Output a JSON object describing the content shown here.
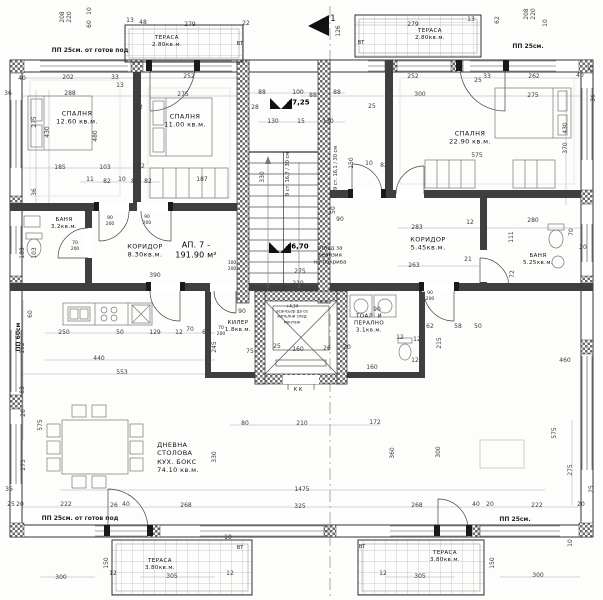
{
  "plan": {
    "apartment": {
      "t": "АП. 7 -\n191.90 м²",
      "x": 196,
      "y": 251
    },
    "rooms": [
      {
        "t": "СПАЛНЯ\n12.60 кв.м.",
        "x": 77,
        "y": 118
      },
      {
        "t": "СПАЛНЯ\n11.00 кв.м.",
        "x": 185,
        "y": 121
      },
      {
        "t": "СПАЛНЯ\n22.90 кв.м.",
        "x": 470,
        "y": 138
      },
      {
        "t": "ТЕРАСА\n2.80кв.м.",
        "x": 167,
        "y": 42,
        "s": 5.5
      },
      {
        "t": "ТЕРАСА\n2.80кв.м.",
        "x": 430,
        "y": 35,
        "s": 5.5
      },
      {
        "t": "БАНЯ\n3.2кв.м.",
        "x": 64,
        "y": 224,
        "s": 5.5
      },
      {
        "t": "КОРИДОР\n8.30кв.м.",
        "x": 145,
        "y": 251
      },
      {
        "t": "КОРИДОР\n5.45кв.м.",
        "x": 428,
        "y": 244
      },
      {
        "t": "БАНЯ\n5.25кв.м.",
        "x": 538,
        "y": 260,
        "s": 5.5
      },
      {
        "t": "КИЛЕР\n1.8кв.м.",
        "x": 238,
        "y": 327,
        "s": 5.5
      },
      {
        "t": "ТОАЛ. И\nПЕРАЛНО\n3.1кв.м.",
        "x": 369,
        "y": 324,
        "s": 5.5
      },
      {
        "t": "ДНЕВНА\nСТОЛОВА\nКУХ. БОКС\n74.10 кв.м.",
        "x": 178,
        "y": 458,
        "align": "left"
      },
      {
        "t": "ТЕРАСА\n3.80кв.м.",
        "x": 160,
        "y": 565,
        "s": 5.5
      },
      {
        "t": "ТЕРАСА\n3.80кв.м.",
        "x": 445,
        "y": 557,
        "s": 5.5
      }
    ],
    "levels": [
      {
        "t": "+7,25",
        "x": 298,
        "y": 103
      },
      {
        "t": "+6,70",
        "x": 297,
        "y": 247
      }
    ],
    "notes": [
      {
        "t": "ПП 25см. от готов под",
        "x": 90,
        "y": 51,
        "b": 1
      },
      {
        "t": "ПП 25см.",
        "x": 528,
        "y": 47,
        "b": 1
      },
      {
        "t": "ПП 25см. от готов под",
        "x": 80,
        "y": 519,
        "b": 1
      },
      {
        "t": "ПП 25см.",
        "x": 515,
        "y": 520,
        "b": 1
      },
      {
        "t": "ПП 60см",
        "x": 19,
        "y": 337,
        "r": -90,
        "b": 1
      },
      {
        "t": "ВТ",
        "x": 240,
        "y": 44,
        "s": 5
      },
      {
        "t": "ВТ",
        "x": 361,
        "y": 43,
        "s": 5
      },
      {
        "t": "ВТ",
        "x": 240,
        "y": 548,
        "s": 5
      },
      {
        "t": "ВТ",
        "x": 362,
        "y": 547,
        "s": 5
      },
      {
        "t": "К К",
        "x": 298,
        "y": 390,
        "s": 5
      },
      {
        "t": "отвод за\nревизия\nна покрива",
        "x": 330,
        "y": 256,
        "s": 5.5
      },
      {
        "t": "9 ст. 16,7 / 30 см",
        "x": 288,
        "y": 174,
        "r": -90,
        "s": 5
      },
      {
        "t": "9 ст. 16,1 / 30 см",
        "x": 336,
        "y": 168,
        "r": -90,
        "s": 5
      },
      {
        "t": "70\n200",
        "x": 75,
        "y": 247,
        "s": 4.5
      },
      {
        "t": "90\n200",
        "x": 110,
        "y": 222,
        "s": 4.5
      },
      {
        "t": "90\n200",
        "x": 147,
        "y": 221,
        "s": 4.5
      },
      {
        "t": "100\n200",
        "x": 232,
        "y": 267,
        "s": 4.5
      },
      {
        "t": "90\n200",
        "x": 430,
        "y": 297,
        "s": 4.5
      },
      {
        "t": "70\n200",
        "x": 221,
        "y": 332,
        "s": 4.5
      },
      {
        "t": "1",
        "x": 333,
        "y": 20,
        "s": 9
      },
      {
        "t": "+4,34\nасансьор да се\nизпълни след\nмонтаж",
        "x": 292,
        "y": 314,
        "s": 4
      }
    ],
    "dimensions": [
      {
        "t": "208",
        "x": 63,
        "y": 17,
        "r": -90
      },
      {
        "t": "220",
        "x": 70,
        "y": 17,
        "r": -90
      },
      {
        "t": "10",
        "x": 90,
        "y": 11,
        "r": -90
      },
      {
        "t": "60",
        "x": 90,
        "y": 24,
        "r": -90
      },
      {
        "t": "13",
        "x": 130,
        "y": 21
      },
      {
        "t": "48",
        "x": 143,
        "y": 23
      },
      {
        "t": "279",
        "x": 190,
        "y": 25
      },
      {
        "t": "22",
        "x": 246,
        "y": 24
      },
      {
        "t": "126",
        "x": 339,
        "y": 31,
        "r": -90
      },
      {
        "t": "13",
        "x": 471,
        "y": 20
      },
      {
        "t": "279",
        "x": 413,
        "y": 25
      },
      {
        "t": "62",
        "x": 498,
        "y": 20,
        "r": -90
      },
      {
        "t": "208",
        "x": 527,
        "y": 14,
        "r": -90
      },
      {
        "t": "220",
        "x": 534,
        "y": 14,
        "r": -90
      },
      {
        "t": "10",
        "x": 546,
        "y": 23,
        "r": -90
      },
      {
        "t": "40",
        "x": 22,
        "y": 79
      },
      {
        "t": "202",
        "x": 68,
        "y": 78
      },
      {
        "t": "33",
        "x": 115,
        "y": 78
      },
      {
        "t": "13",
        "x": 120,
        "y": 86
      },
      {
        "t": "252",
        "x": 189,
        "y": 77
      },
      {
        "t": "252",
        "x": 413,
        "y": 77
      },
      {
        "t": "25",
        "x": 478,
        "y": 81
      },
      {
        "t": "33",
        "x": 487,
        "y": 77
      },
      {
        "t": "262",
        "x": 534,
        "y": 77
      },
      {
        "t": "40",
        "x": 580,
        "y": 76
      },
      {
        "t": "25",
        "x": 592,
        "y": 68,
        "r": -90
      },
      {
        "t": "36",
        "x": 8,
        "y": 94
      },
      {
        "t": "288",
        "x": 70,
        "y": 94
      },
      {
        "t": "275",
        "x": 183,
        "y": 95
      },
      {
        "t": "88",
        "x": 313,
        "y": 96
      },
      {
        "t": "300",
        "x": 420,
        "y": 95
      },
      {
        "t": "275",
        "x": 533,
        "y": 96
      },
      {
        "t": "36",
        "x": 594,
        "y": 98,
        "r": -90
      },
      {
        "t": "12",
        "x": 139,
        "y": 108
      },
      {
        "t": "275",
        "x": 35,
        "y": 122,
        "r": -90
      },
      {
        "t": "430",
        "x": 48,
        "y": 132,
        "r": -90
      },
      {
        "t": "480",
        "x": 96,
        "y": 136,
        "r": -90
      },
      {
        "t": "88",
        "x": 262,
        "y": 93
      },
      {
        "t": "100",
        "x": 298,
        "y": 93
      },
      {
        "t": "88",
        "x": 337,
        "y": 93
      },
      {
        "t": "28",
        "x": 255,
        "y": 108
      },
      {
        "t": "25",
        "x": 372,
        "y": 107
      },
      {
        "t": "130",
        "x": 273,
        "y": 122
      },
      {
        "t": "15",
        "x": 301,
        "y": 122
      },
      {
        "t": "130",
        "x": 328,
        "y": 122
      },
      {
        "t": "330",
        "x": 263,
        "y": 177,
        "r": -90
      },
      {
        "t": "150",
        "x": 352,
        "y": 163,
        "r": -90
      },
      {
        "t": "10",
        "x": 369,
        "y": 164
      },
      {
        "t": "82",
        "x": 384,
        "y": 166
      },
      {
        "t": "50",
        "x": 334,
        "y": 210,
        "r": -90
      },
      {
        "t": "90",
        "x": 340,
        "y": 220
      },
      {
        "t": "185",
        "x": 60,
        "y": 168
      },
      {
        "t": "103",
        "x": 105,
        "y": 168
      },
      {
        "t": "12",
        "x": 141,
        "y": 167
      },
      {
        "t": "11",
        "x": 90,
        "y": 180
      },
      {
        "t": "82",
        "x": 107,
        "y": 182
      },
      {
        "t": "10",
        "x": 122,
        "y": 180
      },
      {
        "t": "8",
        "x": 133,
        "y": 182
      },
      {
        "t": "82",
        "x": 148,
        "y": 182
      },
      {
        "t": "36",
        "x": 35,
        "y": 192,
        "r": -90
      },
      {
        "t": "103",
        "x": 35,
        "y": 253,
        "r": -90
      },
      {
        "t": "50",
        "x": 88,
        "y": 208,
        "r": -90
      },
      {
        "t": "183",
        "x": 23,
        "y": 253,
        "r": -90
      },
      {
        "t": "187",
        "x": 202,
        "y": 180
      },
      {
        "t": "390",
        "x": 155,
        "y": 276
      },
      {
        "t": "275",
        "x": 300,
        "y": 272
      },
      {
        "t": "210",
        "x": 298,
        "y": 284
      },
      {
        "t": "575",
        "x": 477,
        "y": 156
      },
      {
        "t": "283",
        "x": 417,
        "y": 228
      },
      {
        "t": "12",
        "x": 470,
        "y": 223
      },
      {
        "t": "280",
        "x": 533,
        "y": 221
      },
      {
        "t": "263",
        "x": 414,
        "y": 266
      },
      {
        "t": "21",
        "x": 468,
        "y": 260
      },
      {
        "t": "111",
        "x": 512,
        "y": 237,
        "r": -90
      },
      {
        "t": "72",
        "x": 513,
        "y": 274,
        "r": -90
      },
      {
        "t": "70",
        "x": 572,
        "y": 232,
        "r": -90
      },
      {
        "t": "20",
        "x": 583,
        "y": 248
      },
      {
        "t": "430",
        "x": 566,
        "y": 128,
        "r": -90
      },
      {
        "t": "370",
        "x": 566,
        "y": 148,
        "r": -90
      },
      {
        "t": "60",
        "x": 31,
        "y": 314,
        "r": -90
      },
      {
        "t": "250",
        "x": 64,
        "y": 333
      },
      {
        "t": "50",
        "x": 120,
        "y": 333
      },
      {
        "t": "129",
        "x": 155,
        "y": 333
      },
      {
        "t": "12",
        "x": 179,
        "y": 333
      },
      {
        "t": "70",
        "x": 190,
        "y": 330
      },
      {
        "t": "69",
        "x": 206,
        "y": 333
      },
      {
        "t": "152",
        "x": 23,
        "y": 348,
        "r": -90
      },
      {
        "t": "440",
        "x": 99,
        "y": 359
      },
      {
        "t": "553",
        "x": 122,
        "y": 373
      },
      {
        "t": "63",
        "x": 23,
        "y": 390,
        "r": -90
      },
      {
        "t": "26",
        "x": 24,
        "y": 413,
        "r": -90
      },
      {
        "t": "575",
        "x": 41,
        "y": 425,
        "r": -90
      },
      {
        "t": "245",
        "x": 215,
        "y": 347,
        "r": -90
      },
      {
        "t": "75",
        "x": 250,
        "y": 352
      },
      {
        "t": "25",
        "x": 277,
        "y": 347
      },
      {
        "t": "160",
        "x": 298,
        "y": 350
      },
      {
        "t": "26",
        "x": 327,
        "y": 349
      },
      {
        "t": "20",
        "x": 347,
        "y": 348
      },
      {
        "t": "160",
        "x": 372,
        "y": 368
      },
      {
        "t": "12",
        "x": 400,
        "y": 338
      },
      {
        "t": "12",
        "x": 417,
        "y": 340
      },
      {
        "t": "90",
        "x": 242,
        "y": 312
      },
      {
        "t": "90",
        "x": 377,
        "y": 310
      },
      {
        "t": "62",
        "x": 430,
        "y": 327
      },
      {
        "t": "58",
        "x": 458,
        "y": 327
      },
      {
        "t": "50",
        "x": 478,
        "y": 327
      },
      {
        "t": "215",
        "x": 440,
        "y": 343,
        "r": -90
      },
      {
        "t": "12",
        "x": 415,
        "y": 361
      },
      {
        "t": "460",
        "x": 565,
        "y": 361
      },
      {
        "t": "80",
        "x": 245,
        "y": 424
      },
      {
        "t": "210",
        "x": 302,
        "y": 424
      },
      {
        "t": "330",
        "x": 215,
        "y": 457,
        "r": -90
      },
      {
        "t": "1475",
        "x": 302,
        "y": 490
      },
      {
        "t": "325",
        "x": 300,
        "y": 507
      },
      {
        "t": "26",
        "x": 114,
        "y": 506
      },
      {
        "t": "40",
        "x": 126,
        "y": 505
      },
      {
        "t": "268",
        "x": 186,
        "y": 506
      },
      {
        "t": "268",
        "x": 417,
        "y": 506
      },
      {
        "t": "40",
        "x": 476,
        "y": 505
      },
      {
        "t": "20",
        "x": 490,
        "y": 505
      },
      {
        "t": "222",
        "x": 537,
        "y": 506
      },
      {
        "t": "20",
        "x": 581,
        "y": 505
      },
      {
        "t": "25",
        "x": 592,
        "y": 489,
        "r": -90
      },
      {
        "t": "222",
        "x": 66,
        "y": 505
      },
      {
        "t": "20",
        "x": 20,
        "y": 505
      },
      {
        "t": "25",
        "x": 11,
        "y": 505
      },
      {
        "t": "36",
        "x": 9,
        "y": 490
      },
      {
        "t": "275",
        "x": 24,
        "y": 465,
        "r": -90
      },
      {
        "t": "172",
        "x": 375,
        "y": 423
      },
      {
        "t": "360",
        "x": 393,
        "y": 453,
        "r": -90
      },
      {
        "t": "300",
        "x": 439,
        "y": 452,
        "r": -90
      },
      {
        "t": "575",
        "x": 555,
        "y": 433,
        "r": -90
      },
      {
        "t": "275",
        "x": 571,
        "y": 470,
        "r": -90
      },
      {
        "t": "150",
        "x": 107,
        "y": 563,
        "r": -90
      },
      {
        "t": "305",
        "x": 172,
        "y": 577
      },
      {
        "t": "300",
        "x": 61,
        "y": 578
      },
      {
        "t": "150",
        "x": 493,
        "y": 563,
        "r": -90
      },
      {
        "t": "305",
        "x": 420,
        "y": 577
      },
      {
        "t": "300",
        "x": 538,
        "y": 576
      },
      {
        "t": "10",
        "x": 571,
        "y": 543,
        "r": -90
      },
      {
        "t": "10",
        "x": 228,
        "y": 538
      },
      {
        "t": "12",
        "x": 113,
        "y": 574
      },
      {
        "t": "12",
        "x": 383,
        "y": 574
      },
      {
        "t": "12",
        "x": 230,
        "y": 574
      }
    ],
    "colors": {
      "line": "#2f2f2f",
      "dim": "#3a3a3a",
      "hatch": "#666",
      "bg": "#fdfdfc"
    }
  }
}
